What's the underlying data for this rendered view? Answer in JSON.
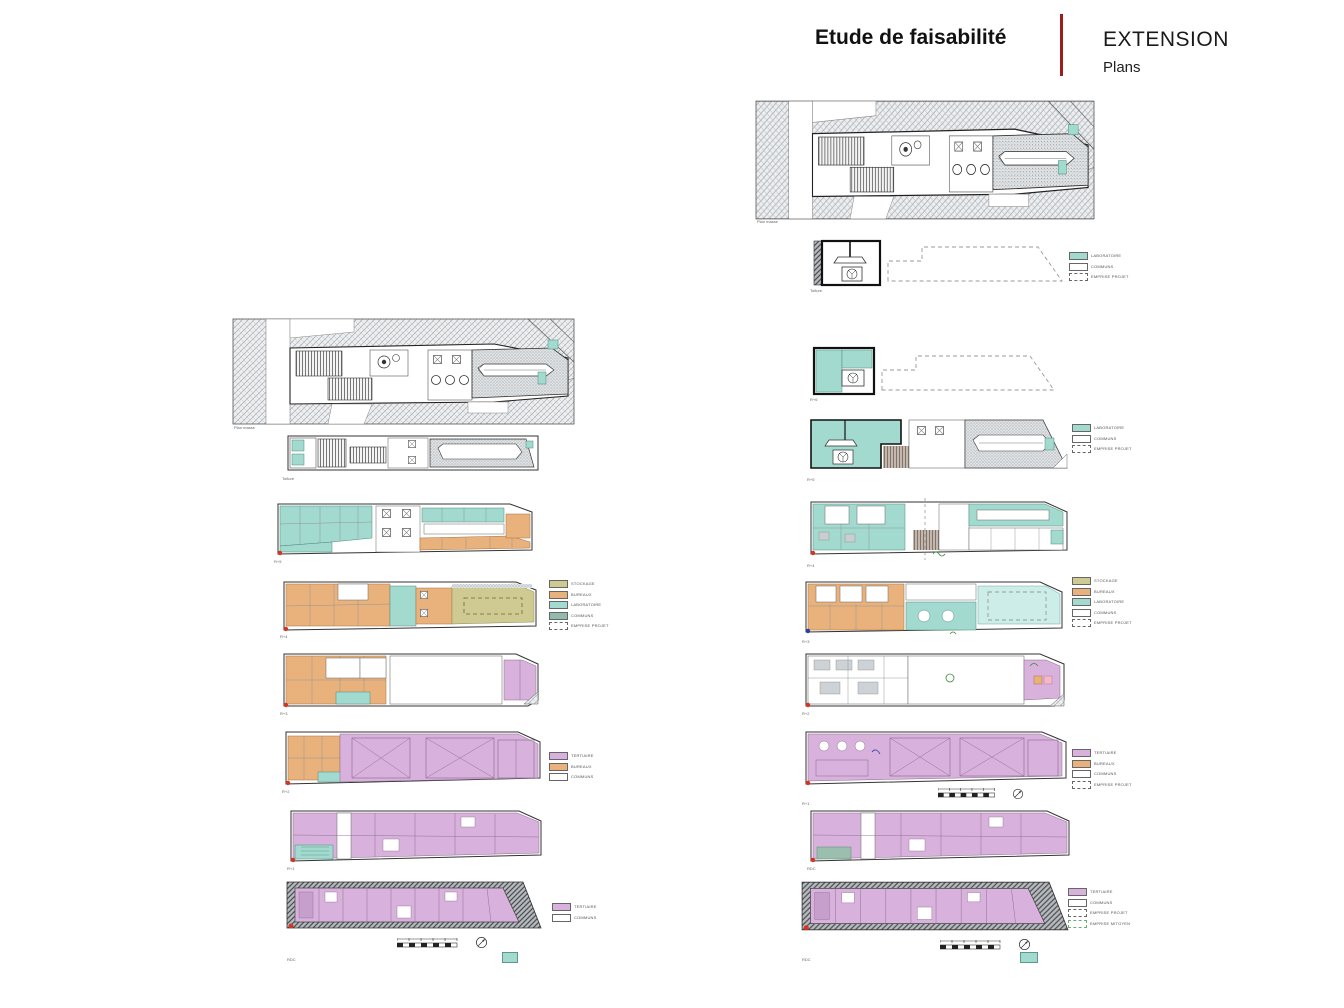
{
  "header": {
    "title": "Etude de faisabilité",
    "section": "EXTENSION",
    "subsection": "Plans",
    "divider_color": "#9e1b1e"
  },
  "colors": {
    "accent_red": "#9e1b1e",
    "teal": "#a3dacf",
    "light_teal": "#cdeee8",
    "orange": "#e9b27c",
    "khaki": "#cfc992",
    "purple": "#d8b2dc",
    "hatch_gray": "#9aa0a6",
    "marker_red": "#d43522"
  },
  "plans": {
    "left": [
      {
        "caption": "Plan masse"
      },
      {
        "caption": "Toiture"
      },
      {
        "caption": "R+5"
      },
      {
        "caption": "R+4"
      },
      {
        "caption": "R+3"
      },
      {
        "caption": "R+2"
      },
      {
        "caption": "R+1"
      },
      {
        "caption": "RDC"
      }
    ],
    "right": [
      {
        "caption": "Plan masse"
      },
      {
        "caption": "Toiture"
      },
      {
        "caption": "R+6"
      },
      {
        "caption": "R+5"
      },
      {
        "caption": "R+4"
      },
      {
        "caption": "R+3"
      },
      {
        "caption": "R+2"
      },
      {
        "caption": "R+1"
      },
      {
        "caption": "RDC"
      }
    ]
  },
  "legends": {
    "roof_right": [
      {
        "label": "LABORATOIRE",
        "fill": "#a3dacf"
      },
      {
        "label": "COMMUNS",
        "fill": "#ffffff"
      },
      {
        "label": "EMPRISE PROJET",
        "fill": "#ffffff",
        "dash": true
      }
    ],
    "r4_right": [
      {
        "label": "LABORATOIRE",
        "fill": "#a3dacf"
      },
      {
        "label": "COMMUNS",
        "fill": "#ffffff"
      },
      {
        "label": "EMPRISE PROJET",
        "fill": "#ffffff",
        "dash": true
      }
    ],
    "main_left": [
      {
        "label": "STOCKAGE",
        "fill": "#cfc992"
      },
      {
        "label": "BUREAUX",
        "fill": "#e9b27c"
      },
      {
        "label": "LABORATOIRE",
        "fill": "#a3dacf"
      },
      {
        "label": "COMMUNS",
        "fill": "#94bab0"
      },
      {
        "label": "EMPRISE PROJET",
        "fill": "#ffffff",
        "dash": true
      }
    ],
    "main_right": [
      {
        "label": "STOCKAGE",
        "fill": "#cfc992"
      },
      {
        "label": "BUREAUX",
        "fill": "#e9b27c"
      },
      {
        "label": "LABORATOIRE",
        "fill": "#a3dacf"
      },
      {
        "label": "COMMUNS",
        "fill": "#ffffff"
      },
      {
        "label": "EMPRISE PROJET",
        "fill": "#ffffff",
        "dash": true
      }
    ],
    "mid_left": [
      {
        "label": "TERTIAIRE",
        "fill": "#d8b2dc"
      },
      {
        "label": "BUREAUX",
        "fill": "#e9b27c"
      },
      {
        "label": "COMMUNS",
        "fill": "#ffffff"
      }
    ],
    "mid_right": [
      {
        "label": "TERTIAIRE",
        "fill": "#d8b2dc"
      },
      {
        "label": "BUREAUX",
        "fill": "#e9b27c"
      },
      {
        "label": "COMMUNS",
        "fill": "#ffffff"
      },
      {
        "label": "EMPRISE PROJET",
        "fill": "#ffffff",
        "dash": true
      }
    ],
    "low_left": [
      {
        "label": "TERTIAIRE",
        "fill": "#d8b2dc"
      },
      {
        "label": "COMMUNS",
        "fill": "#ffffff"
      }
    ],
    "low_right": [
      {
        "label": "TERTIAIRE",
        "fill": "#d8b2dc"
      },
      {
        "label": "COMMUNS",
        "fill": "#ffffff"
      },
      {
        "label": "EMPRISE PROJET",
        "fill": "#ffffff",
        "dash": true
      },
      {
        "label": "EMPRISE MITOYEN",
        "fill": "#ffffff",
        "dash": true,
        "border": "#6fae6f"
      }
    ]
  }
}
